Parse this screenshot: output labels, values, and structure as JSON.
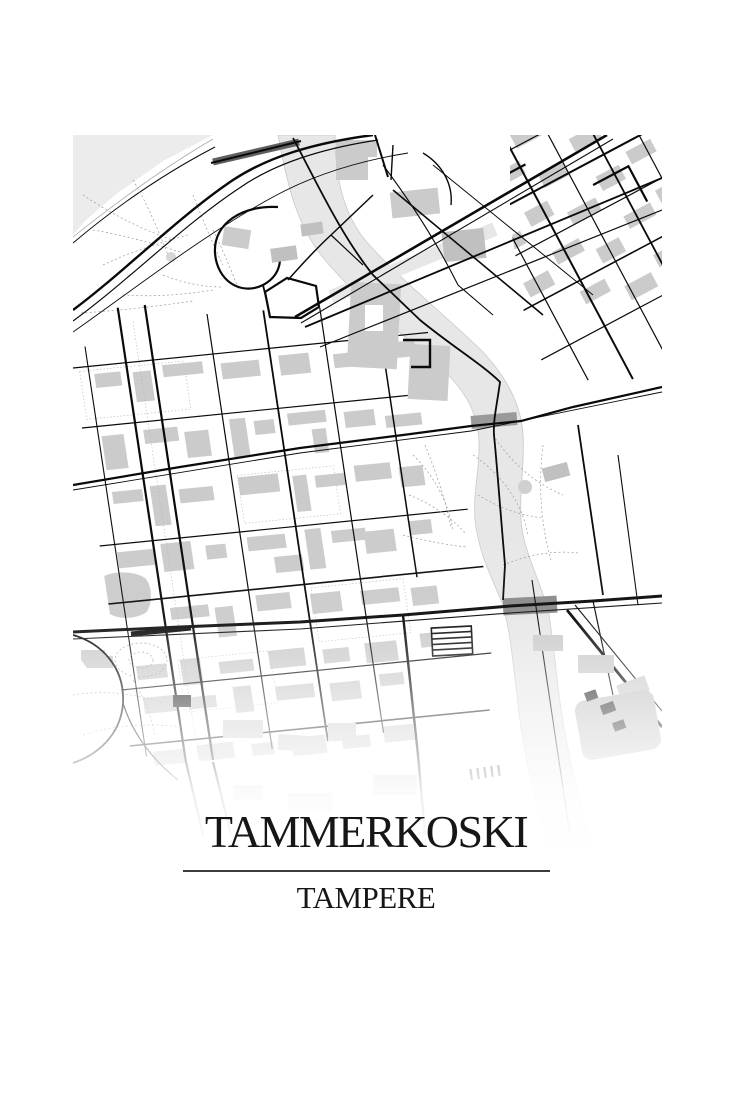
{
  "poster": {
    "title": "TAMMERKOSKI",
    "subtitle": "TAMPERE"
  },
  "map": {
    "style": "black-and-white minimal street map",
    "palette": {
      "background": "#ffffff",
      "road": "#0a0a0a",
      "building": "#cbcbcb",
      "water": "#e7e7e7",
      "park": "#ececec",
      "footpath_dashed": "#9b9b9b",
      "bridge": "#8a8a8a",
      "railway_band": "#5f5f5f",
      "title_text": "#161616",
      "divider_line": "#3c3c3c"
    }
  }
}
